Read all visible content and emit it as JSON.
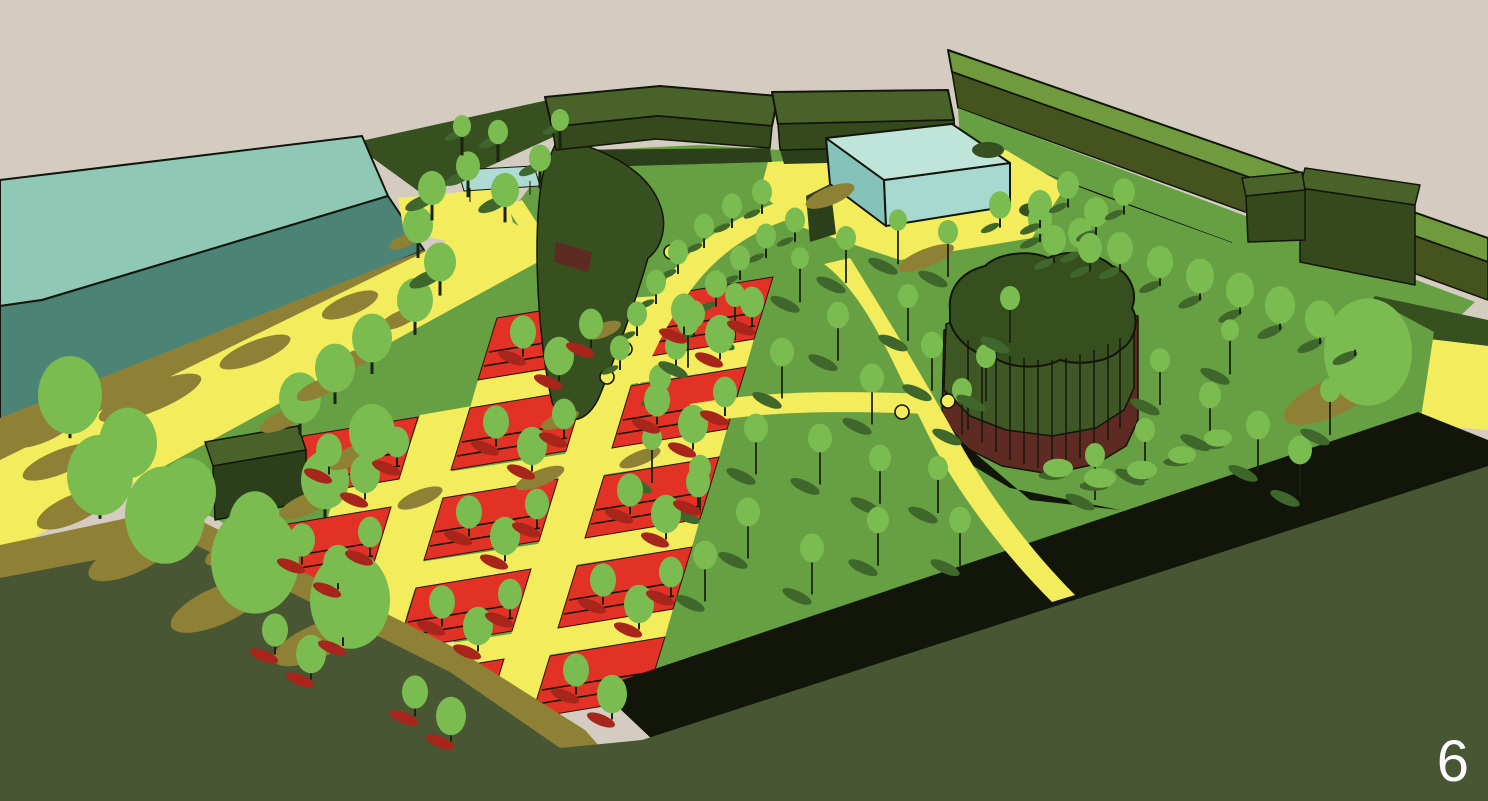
{
  "page": {
    "number": "6"
  },
  "palette": {
    "sky": "#d5ccc1",
    "olive": "#485633",
    "khaki": "#8e8136",
    "khakiLight": "#9c8d3e",
    "grass": "#67a042",
    "grassShadow": "#3f662b",
    "tree": "#7abc4f",
    "hedge": "#375020",
    "hedgeDark": "#2b401a",
    "bldgTop": "#49622a",
    "bldgFace": "#36491c",
    "northRoof": "#6f9b3e",
    "northFace": "#45541f",
    "yellow": "#f3ec5c",
    "red": "#e23125",
    "redShadow": "#a8251c",
    "maroon": "#5e2b23",
    "moundBand": "#3e5825",
    "moundTop": "#35501e",
    "tealRoof": "#8fc8b4",
    "tealFace": "#4b8374",
    "pavRoof": "#bfe5da",
    "pavFaceL": "#84c2ba",
    "pavFaceR": "#a7d9d0",
    "water": "#aedbd4",
    "waterDark": "#8ec7c0",
    "trunk": "#1c2410",
    "ink": "#12150a",
    "page": "#ffffff"
  }
}
